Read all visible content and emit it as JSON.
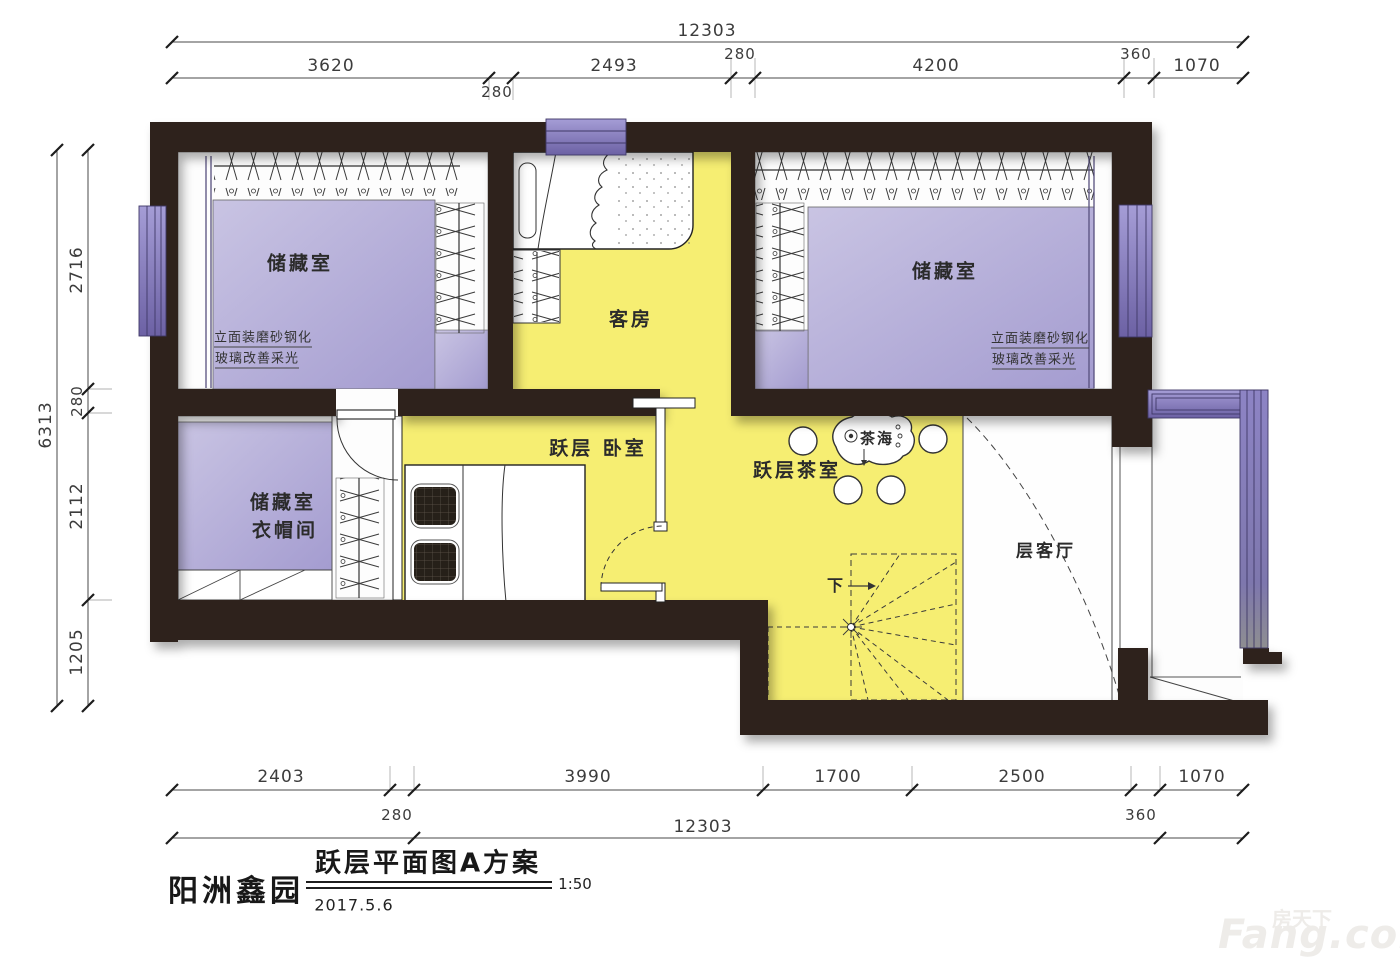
{
  "title_block": {
    "project": "阳洲鑫园",
    "drawing_title": "跃层平面图A方案",
    "date": "2017.5.6",
    "scale": "1:50"
  },
  "watermark": {
    "cn": "房天下",
    "en": "Fang.com"
  },
  "rooms": {
    "storage_left": "储藏室",
    "guest": "客房",
    "storage_right": "储藏室",
    "bedroom": "跃层 卧室",
    "tearoom": "跃层茶室",
    "tea_table": "茶海",
    "cloak1": "储藏室",
    "cloak2": "衣帽间",
    "living": "层客厅",
    "stair_down": "下",
    "stair_arrow": "→"
  },
  "notes": {
    "glass_line1": "立面装磨砂钢化",
    "glass_line2": "玻璃改善采光"
  },
  "dims_top": {
    "total": "12303",
    "a": "3620",
    "b": "2493",
    "c": "280",
    "d": "4200",
    "e": "360",
    "f": "1070",
    "sub": "280"
  },
  "dims_left": {
    "total": "6313",
    "a": "2716",
    "b": "280",
    "c": "2112",
    "d": "1205"
  },
  "dims_bottom": {
    "a": "2403",
    "b": "3990",
    "c": "1700",
    "d": "2500",
    "e": "1070",
    "sub280": "280",
    "total": "12303",
    "sub360": "360"
  },
  "colors": {
    "wall": "#2d211d",
    "floor_storage": "#b3abd8",
    "floor_living_area": "#f6ee72",
    "window": "#8d84c5",
    "line": "#333333"
  }
}
